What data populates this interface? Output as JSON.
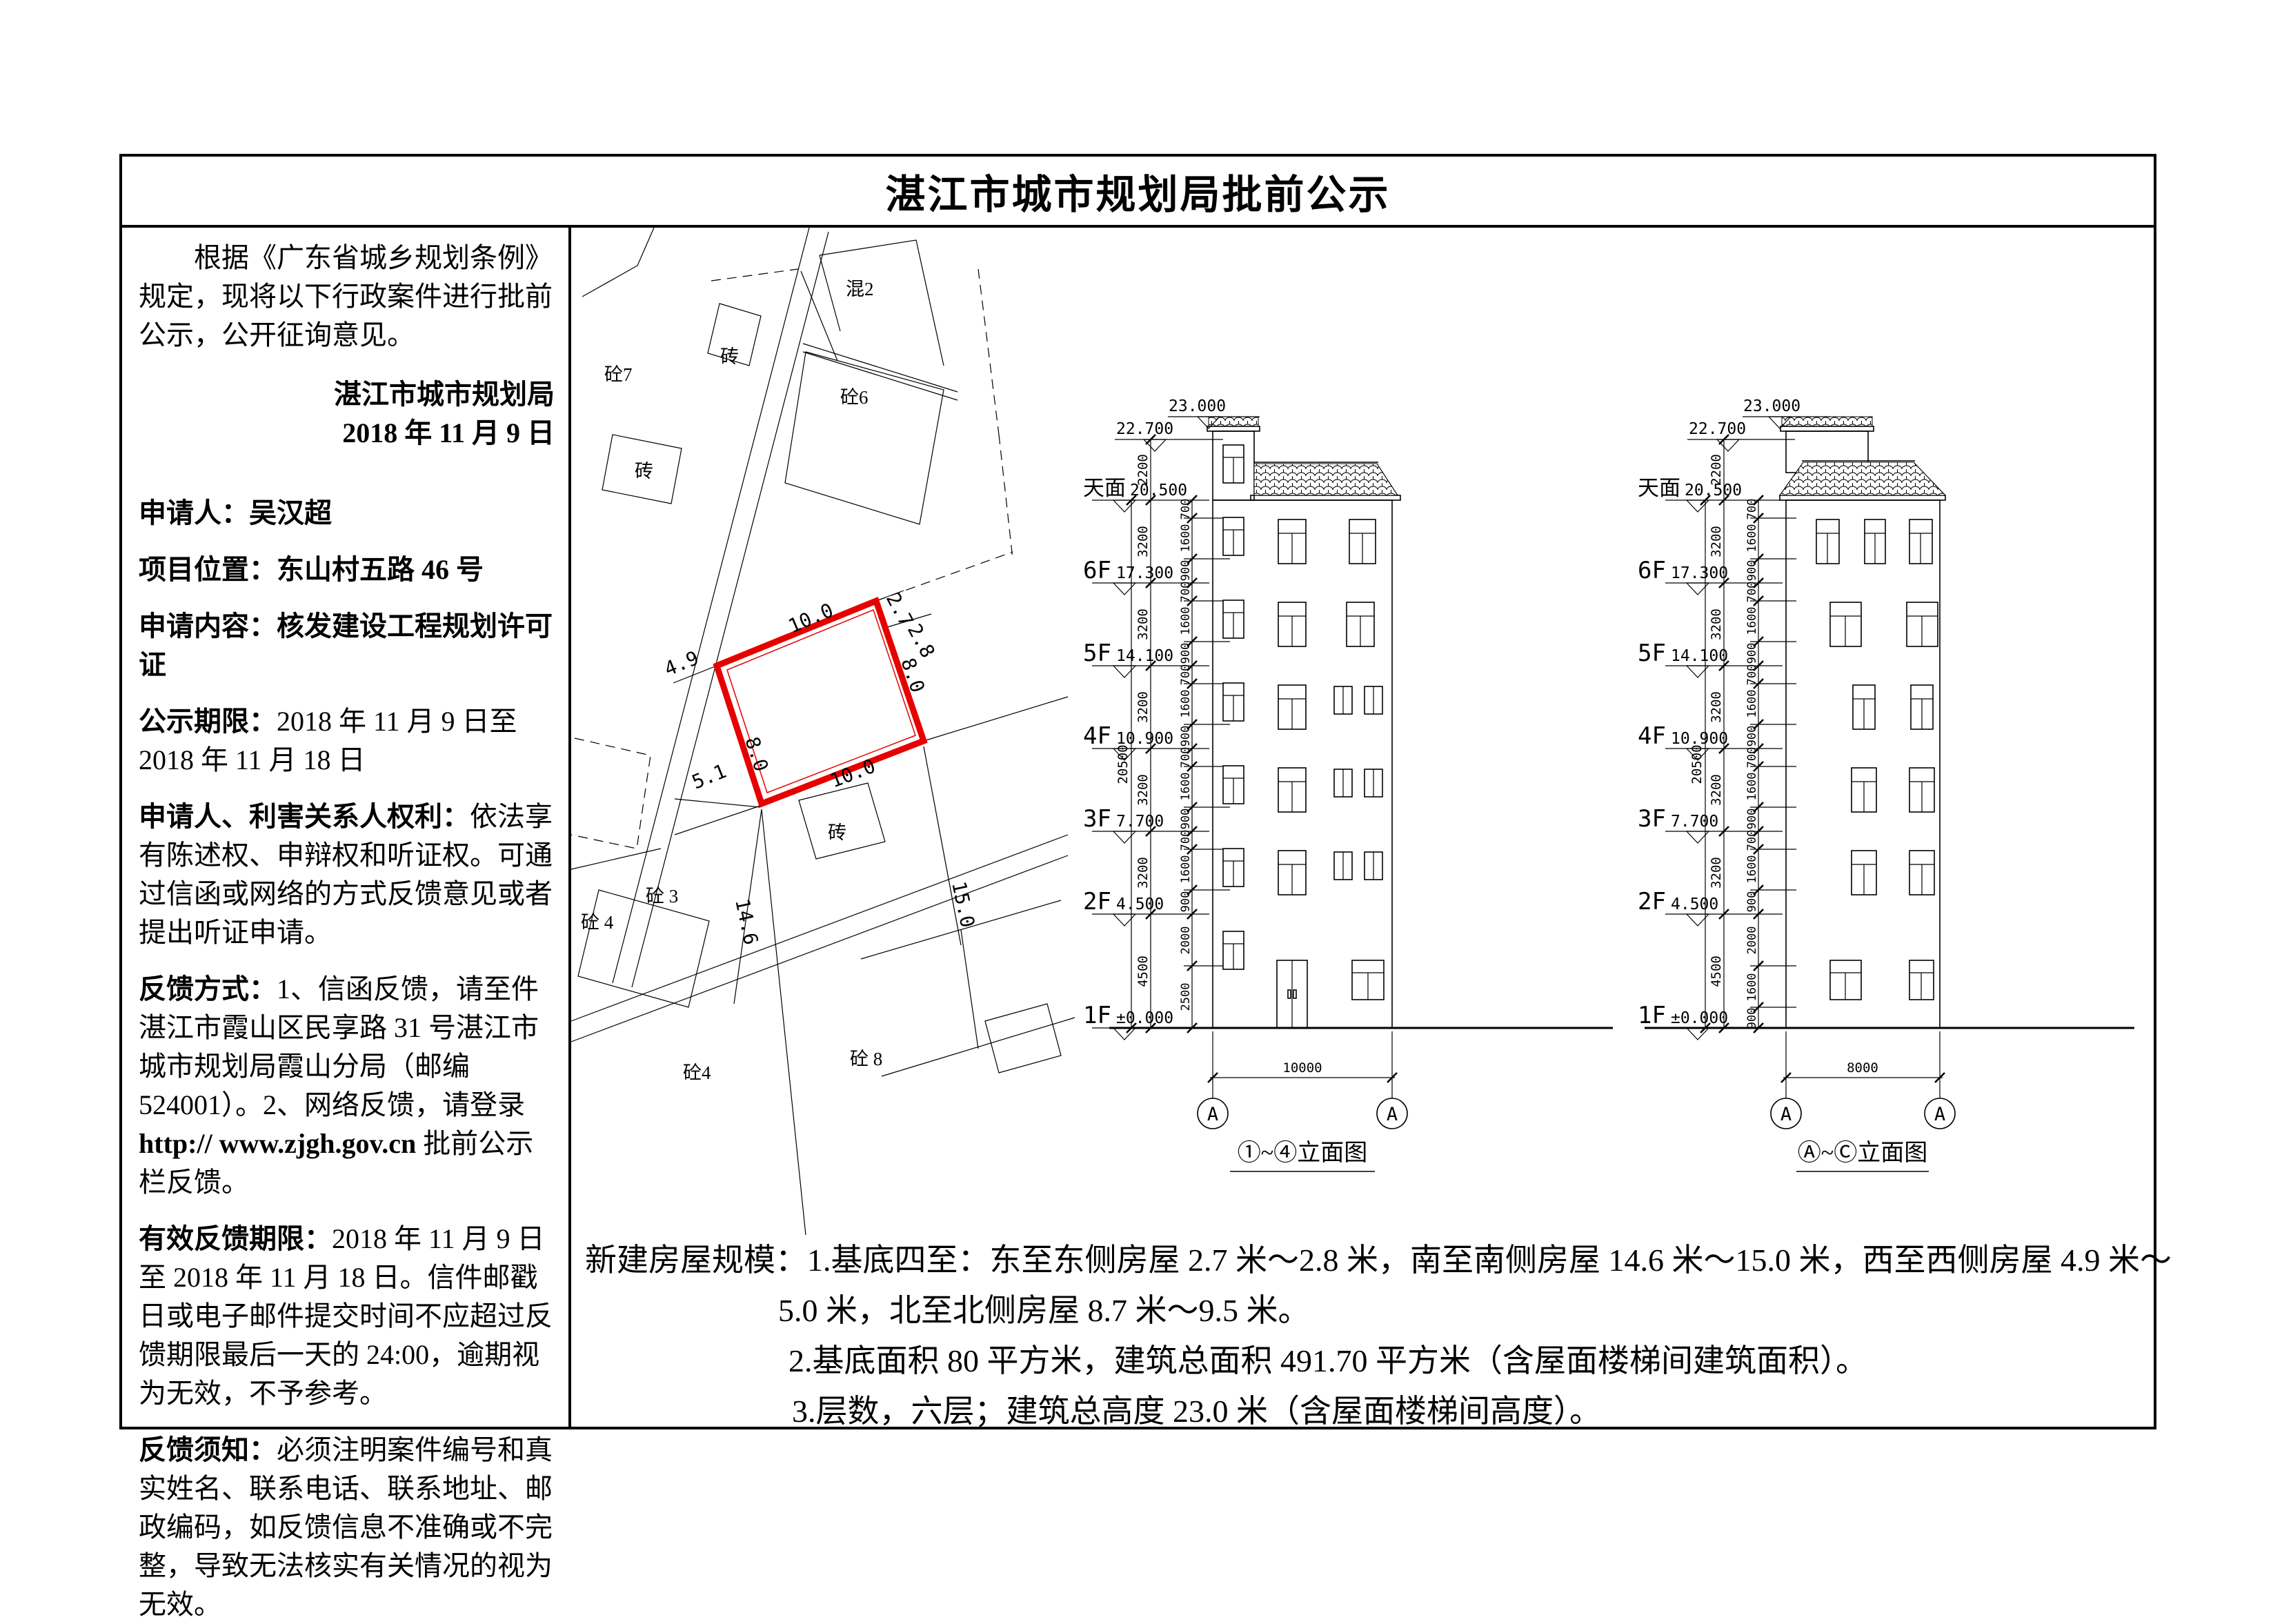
{
  "title": "湛江市城市规划局批前公示",
  "sidebar": {
    "intro": "根据《广东省城乡规划条例》规定，现将以下行政案件进行批前公示，公开征询意见。",
    "org": "湛江市城市规划局",
    "org_date": "2018 年 11 月 9 日",
    "applicant_label": "申请人：",
    "applicant": "吴汉超",
    "location_label": "项目位置：",
    "location": "东山村五路 46 号",
    "content_label": "申请内容：",
    "content": "核发建设工程规划许可证",
    "period_label": "公示期限：",
    "period": "2018 年 11 月 9 日至 2018 年 11 月 18 日",
    "rights_label": "申请人、利害关系人权利：",
    "rights": "依法享有陈述权、申辩权和听证权。可通过信函或网络的方式反馈意见或者提出听证申请。",
    "feedback_label": "反馈方式：",
    "feedback_1": "1、信函反馈，请至件湛江市霞山区民享路 31 号湛江市城市规划局霞山分局（邮编 524001）。2、网络反馈，请登录 ",
    "feedback_url": "http:// www.zjgh.gov.cn",
    "feedback_2": " 批前公示栏反馈。",
    "valid_label": "有效反馈期限：",
    "valid": "2018 年 11 月 9 日至 2018 年 11 月 18 日。信件邮戳日或电子邮件提交时间不应超过反馈期限最后一天的 24:00，逾期视为无效，不予参考。",
    "notice_label": "反馈须知：",
    "notice": "必须注明案件编号和真实姓名、联系电话、联系地址、邮政编码，如反馈信息不准确或不完整，导致无法核实有关情况的视为无效。"
  },
  "site_plan": {
    "plot_color": "#e60000",
    "dim_top": "10.0",
    "dim_bottom": "10.0",
    "dim_left": "8.0",
    "dim_right": "8.0",
    "east1": "2.7",
    "east2": "2.8",
    "west1": "4.9",
    "west2": "5.1",
    "south1": "14.6",
    "south2": "15.0",
    "labels": {
      "l1": "砼7",
      "l2": "混2",
      "l3": "砼6",
      "l4": "砖",
      "l5": "砖",
      "l6": "砼 3",
      "l7": "砼 4",
      "l8": "砖",
      "l9": "砼4",
      "l10": "砼 8"
    }
  },
  "levels": [
    {
      "name": "天面",
      "elev": "20.500"
    },
    {
      "name": "6F",
      "elev": "17.300"
    },
    {
      "name": "5F",
      "elev": "14.100"
    },
    {
      "name": "4F",
      "elev": "10.900"
    },
    {
      "name": "3F",
      "elev": "7.700"
    },
    {
      "name": "2F",
      "elev": "4.500"
    },
    {
      "name": "1F",
      "elev": "±0.000"
    }
  ],
  "marks": {
    "roof_small": "23.000",
    "roof_main": "22.700"
  },
  "floor_dims": [
    "2200",
    "3200",
    "3200",
    "3200",
    "3200",
    "3200",
    "4500"
  ],
  "overall_dim": "20500",
  "sub_dims": [
    "700",
    "1600",
    "900"
  ],
  "bottom_dims_left": [
    "2000",
    "2500"
  ],
  "bottom_dims_right": [
    "2000",
    "1600",
    "900"
  ],
  "elev_left": {
    "caption": "①~④立面图",
    "width": "10000",
    "axis_l": "A",
    "axis_r": "A"
  },
  "elev_right": {
    "caption": "Ⓐ~Ⓒ立面图",
    "width": "8000",
    "axis_l": "A",
    "axis_r": "A"
  },
  "notes": {
    "line1": "新建房屋规模：1.基底四至：东至东侧房屋 2.7 米～2.8 米，南至南侧房屋 14.6 米～15.0 米，西至西侧房屋 4.9 米～",
    "line2": "5.0 米，北至北侧房屋 8.7 米～9.5 米。",
    "line3": "2.基底面积 80 平方米，建筑总面积 491.70 平方米（含屋面楼梯间建筑面积）。",
    "line4": "3.层数，六层；建筑总高度 23.0 米（含屋面楼梯间高度）。"
  }
}
